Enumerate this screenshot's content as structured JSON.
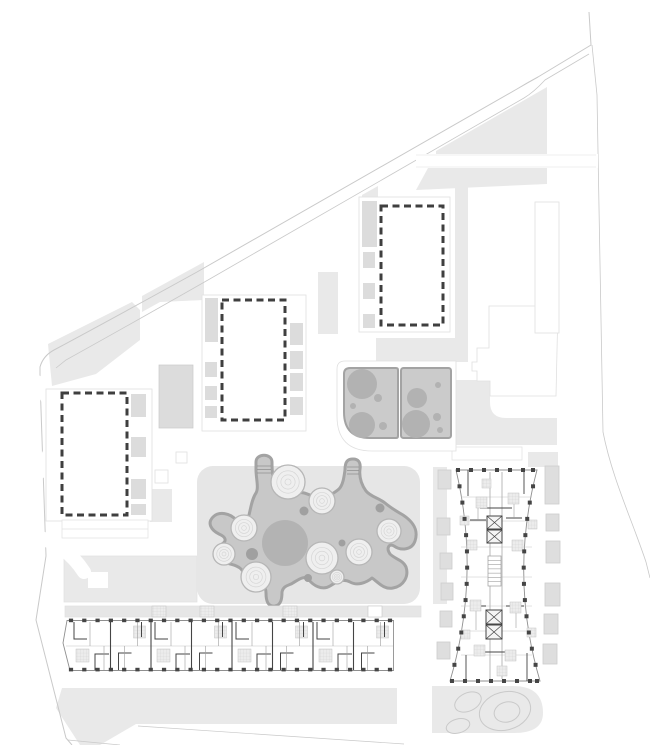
{
  "meta": {
    "title": "Residential masterplan — ground floor site plan",
    "description": "Architectural site plan with three dashed planned building volumes, a slab apartment building floor plan, an hourglass tower floor plan, a central playground with organic blob and contour mounds, two play panels and landscaped areas"
  },
  "palette": {
    "bg": "#ffffff",
    "ground": "#e9e9e9",
    "ground-dark": "#dcdcdc",
    "plaza": "#e6e6e6",
    "boundary": "#c9c9c9",
    "faint": "#e0e0e0",
    "panel-fill": "#cbcbcb",
    "panel-stroke": "#a3a3a3",
    "panel-circle": "#b2b2b2",
    "blob-fill": "#c8c8c8",
    "blob-stroke": "#a3a3a3",
    "blob-dot": "#a0a0a0",
    "big-circle": "#b3b3b3",
    "mound-fill": "#efefef",
    "mound-ring": "#d6d6d6",
    "mound-stroke": "#b6b6b6",
    "plan-outline": "#8f8f8f",
    "plan-wall": "#454545",
    "plan-thin": "#9d9d9d",
    "plan-light": "#c6c6c6",
    "hatch-fill": "#ececec",
    "hatch-line": "#d2d2d2",
    "dash": "#3f3f3f",
    "balcony-fill": "#dedede",
    "balcony-stroke": "#cccccc",
    "white": "#ffffff"
  },
  "buildings": {
    "block_a": {
      "name": "Planned volume A",
      "dash": [
        381,
        206,
        62,
        119
      ],
      "balconies_left": [
        [
          362,
          201,
          15,
          46
        ],
        [
          363,
          252,
          12,
          16
        ],
        [
          363,
          283,
          12,
          16
        ],
        [
          363,
          314,
          12,
          14
        ]
      ]
    },
    "block_b": {
      "name": "Planned volume B",
      "dash": [
        222,
        300,
        63,
        120
      ],
      "balconies_left": [
        [
          205,
          298,
          13,
          44
        ],
        [
          205,
          362,
          12,
          15
        ],
        [
          205,
          386,
          12,
          14
        ],
        [
          205,
          406,
          12,
          12
        ]
      ],
      "balconies_right": [
        [
          290,
          323,
          13,
          22
        ],
        [
          290,
          351,
          13,
          18
        ],
        [
          290,
          373,
          13,
          18
        ],
        [
          290,
          397,
          13,
          18
        ]
      ]
    },
    "block_c": {
      "name": "Planned volume C",
      "dash": [
        62,
        393,
        65,
        122
      ],
      "balconies_right": [
        [
          131,
          394,
          15,
          23
        ],
        [
          131,
          437,
          15,
          20
        ],
        [
          131,
          479,
          15,
          20
        ],
        [
          131,
          504,
          15,
          11
        ]
      ]
    },
    "slab": {
      "name": "Slab apartment building floor plan",
      "modules": 8,
      "module_w": 40.5,
      "x0": 70,
      "columns_per_row": 25,
      "col_x0": 71,
      "col_x1": 390,
      "col_top_y": 618.6,
      "col_bot_y": 667.8
    },
    "tower": {
      "name": "Tower apartment building floor plan",
      "top_cols_x": [
        458,
        471,
        484,
        497,
        510,
        523,
        533
      ],
      "bot_cols_x": [
        452,
        465,
        478,
        491,
        504,
        517,
        530,
        537
      ],
      "side_cols": 12,
      "balconies_left": [
        [
          438,
          470,
          13,
          19
        ],
        [
          437,
          518,
          13,
          17
        ],
        [
          440,
          553,
          12,
          16
        ],
        [
          441,
          583,
          12,
          17
        ],
        [
          440,
          611,
          12,
          16
        ],
        [
          437,
          642,
          13,
          17
        ]
      ],
      "balconies_right": [
        [
          545,
          466,
          14,
          38
        ],
        [
          546,
          514,
          13,
          17
        ],
        [
          546,
          541,
          14,
          22
        ],
        [
          545,
          583,
          15,
          23
        ],
        [
          544,
          614,
          14,
          20
        ],
        [
          543,
          644,
          14,
          20
        ]
      ],
      "floor_lines": [
        497,
        521,
        547,
        577,
        606,
        631,
        655
      ],
      "hatch_boxes": [
        [
          476,
          497,
          11
        ],
        [
          508,
          493,
          11
        ],
        [
          467,
          540,
          10
        ],
        [
          512,
          540,
          11
        ],
        [
          470,
          600,
          11
        ],
        [
          510,
          602,
          11
        ],
        [
          474,
          645,
          11
        ],
        [
          505,
          650,
          11
        ],
        [
          482,
          479,
          9
        ],
        [
          497,
          666,
          10
        ],
        [
          460,
          516,
          9
        ],
        [
          528,
          520,
          9
        ],
        [
          461,
          630,
          9
        ],
        [
          527,
          628,
          9
        ]
      ],
      "elevators": [
        [
          487,
          516,
          15,
          13
        ],
        [
          487,
          530,
          15,
          13
        ],
        [
          486,
          610,
          16,
          14
        ],
        [
          486,
          625,
          16,
          14
        ]
      ],
      "stair": {
        "x": 488,
        "y": 556,
        "w": 13,
        "h": 30,
        "rungs": 7
      }
    }
  },
  "playground": {
    "big_circle": [
      285,
      543,
      23
    ],
    "mounds": [
      [
        288,
        482,
        17
      ],
      [
        322,
        501,
        13
      ],
      [
        244,
        528,
        13
      ],
      [
        224,
        554,
        11
      ],
      [
        256,
        577,
        15
      ],
      [
        322,
        558,
        16
      ],
      [
        389,
        531,
        12
      ],
      [
        359,
        552,
        13
      ],
      [
        337,
        577,
        7
      ]
    ],
    "dots": [
      [
        304,
        511,
        4.5
      ],
      [
        342,
        543,
        3.5
      ],
      [
        252,
        554,
        6
      ],
      [
        308,
        578,
        4
      ],
      [
        380,
        508,
        4.5
      ]
    ]
  },
  "play_panels": {
    "left": {
      "circles": [
        [
          362,
          384,
          15
        ],
        [
          362,
          425,
          13
        ],
        [
          378,
          398,
          4
        ],
        [
          353,
          406,
          3
        ],
        [
          383,
          426,
          4
        ]
      ]
    },
    "right": {
      "circles": [
        [
          417,
          398,
          10
        ],
        [
          416,
          424,
          14
        ],
        [
          438,
          385,
          3
        ],
        [
          437,
          417,
          4
        ],
        [
          440,
          430,
          3
        ]
      ]
    }
  },
  "walkway": {
    "hatch_boxes": [
      152,
      200,
      283
    ],
    "white_boxes": [
      368
    ],
    "y": 606,
    "h": 11
  },
  "landscape_ellipses": [
    [
      505,
      711,
      26,
      19,
      -15
    ],
    [
      507,
      712,
      13,
      10,
      -15
    ],
    [
      468,
      702,
      14,
      9,
      -25
    ],
    [
      458,
      726,
      12,
      7,
      -15
    ]
  ]
}
